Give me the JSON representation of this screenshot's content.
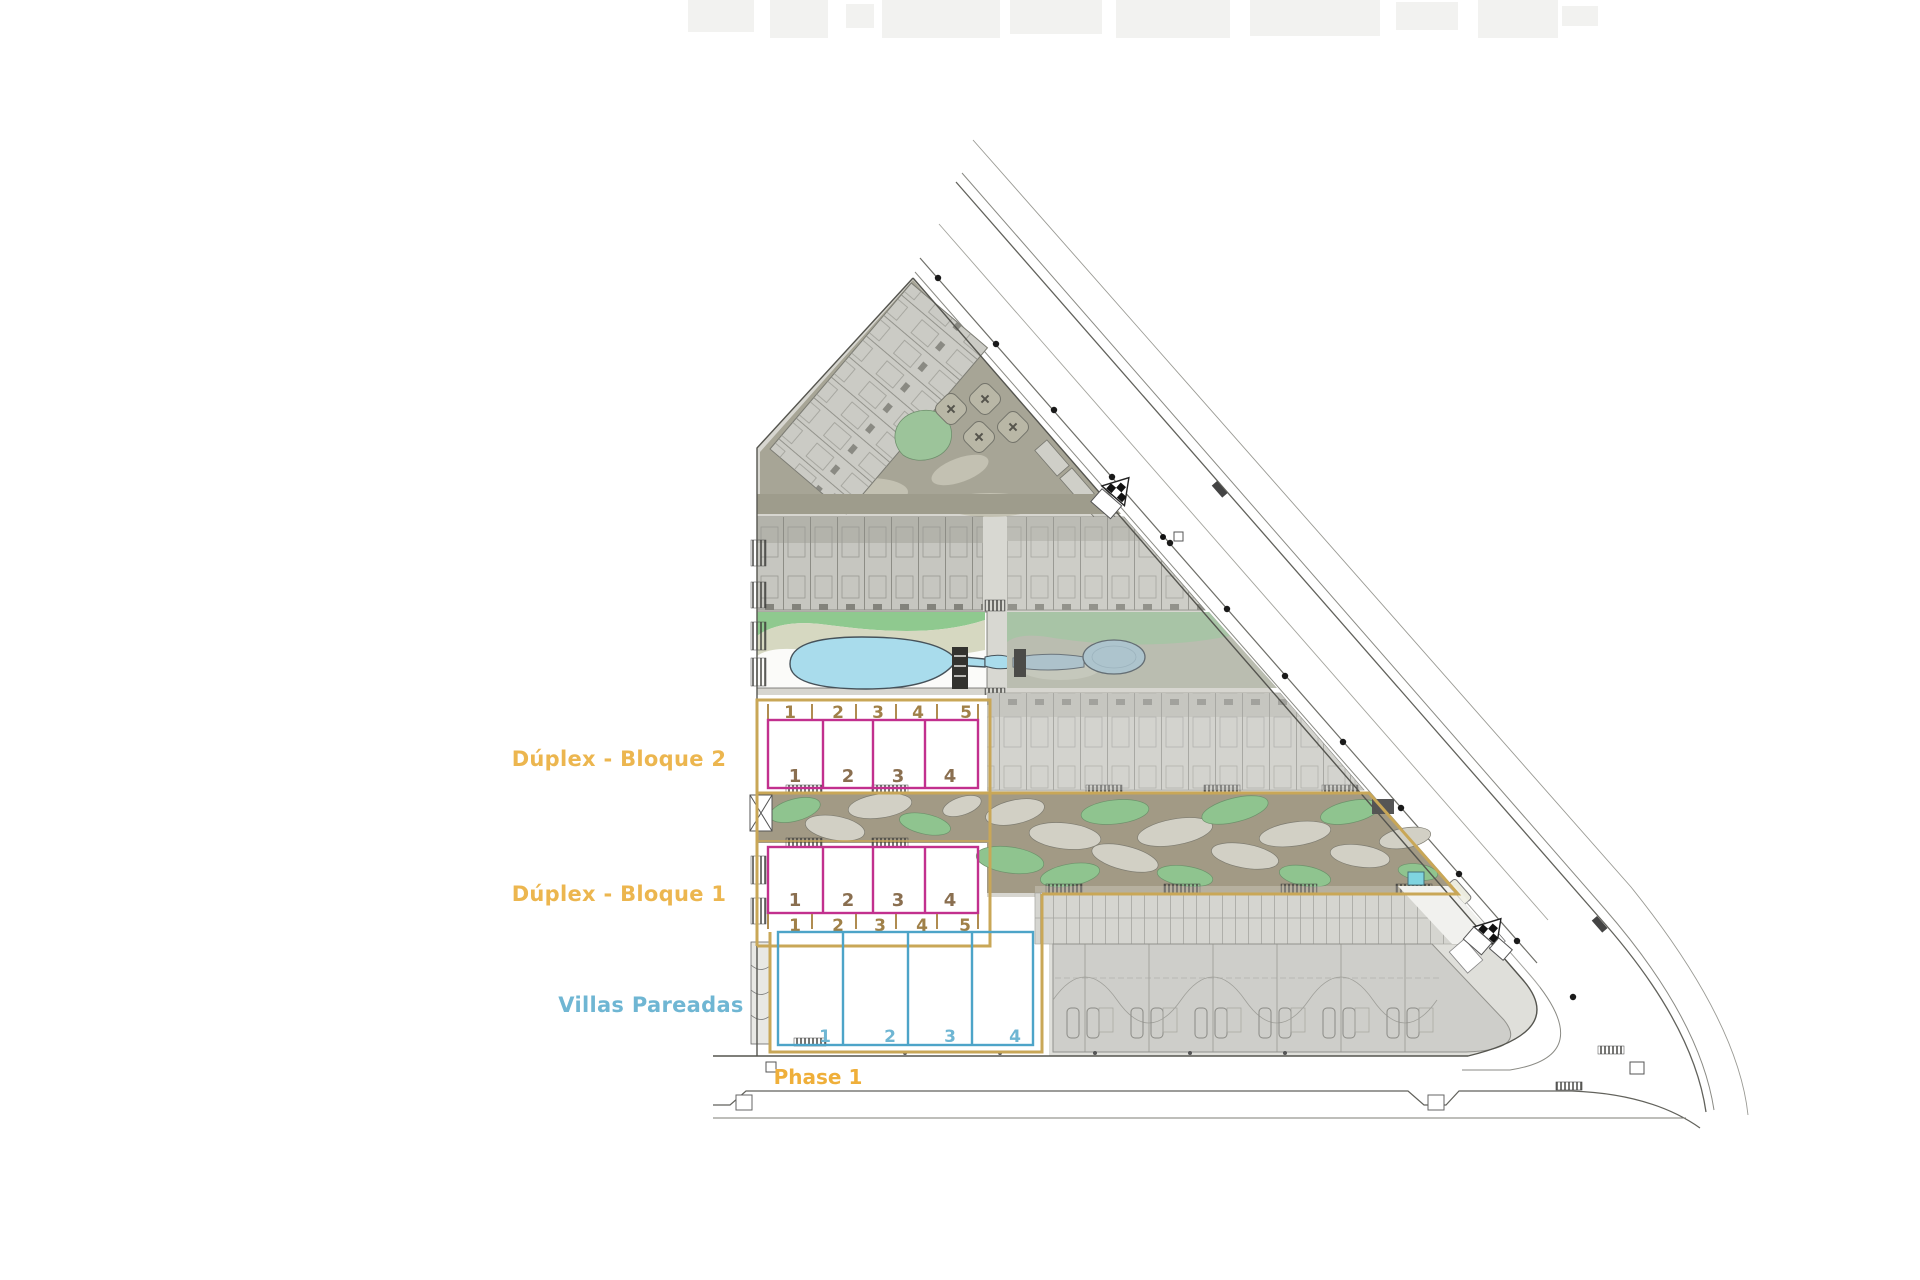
{
  "labels": {
    "bloque2": "Dúplex - Bloque 2",
    "bloque1": "Dúplex - Bloque 1",
    "villas": "Villas Pareadas",
    "phase": "Phase 1"
  },
  "blocks": {
    "bloque2": {
      "top_numbers": [
        "1",
        "2",
        "3",
        "4",
        "5"
      ],
      "unit_numbers": [
        "1",
        "2",
        "3",
        "4"
      ]
    },
    "bloque1": {
      "unit_numbers": [
        "1",
        "2",
        "3",
        "4"
      ],
      "bottom_numbers": [
        "1",
        "2",
        "3",
        "4",
        "5"
      ]
    },
    "villas": {
      "unit_numbers": [
        "1",
        "2",
        "3",
        "4"
      ]
    }
  },
  "colors": {
    "accent_orange": "#ECB64F",
    "phase_orange": "#EFAF3A",
    "accent_blue": "#6FB6D3",
    "villas_blue": "#4DA4C8",
    "magenta": "#C2308E",
    "tan_boundary": "#C9A757",
    "tan_number": "#A08048",
    "unit_number": "#8A6F50",
    "pool_blue": "#A9DCEC",
    "pool_muted": "#A2BCC7",
    "green_bright": "#8FC98F",
    "green_muted": "#9CBC9A",
    "building_gray": "#C6C6C0",
    "courtyard_olive": "#A7A596",
    "garden_olive": "#A29A85"
  }
}
